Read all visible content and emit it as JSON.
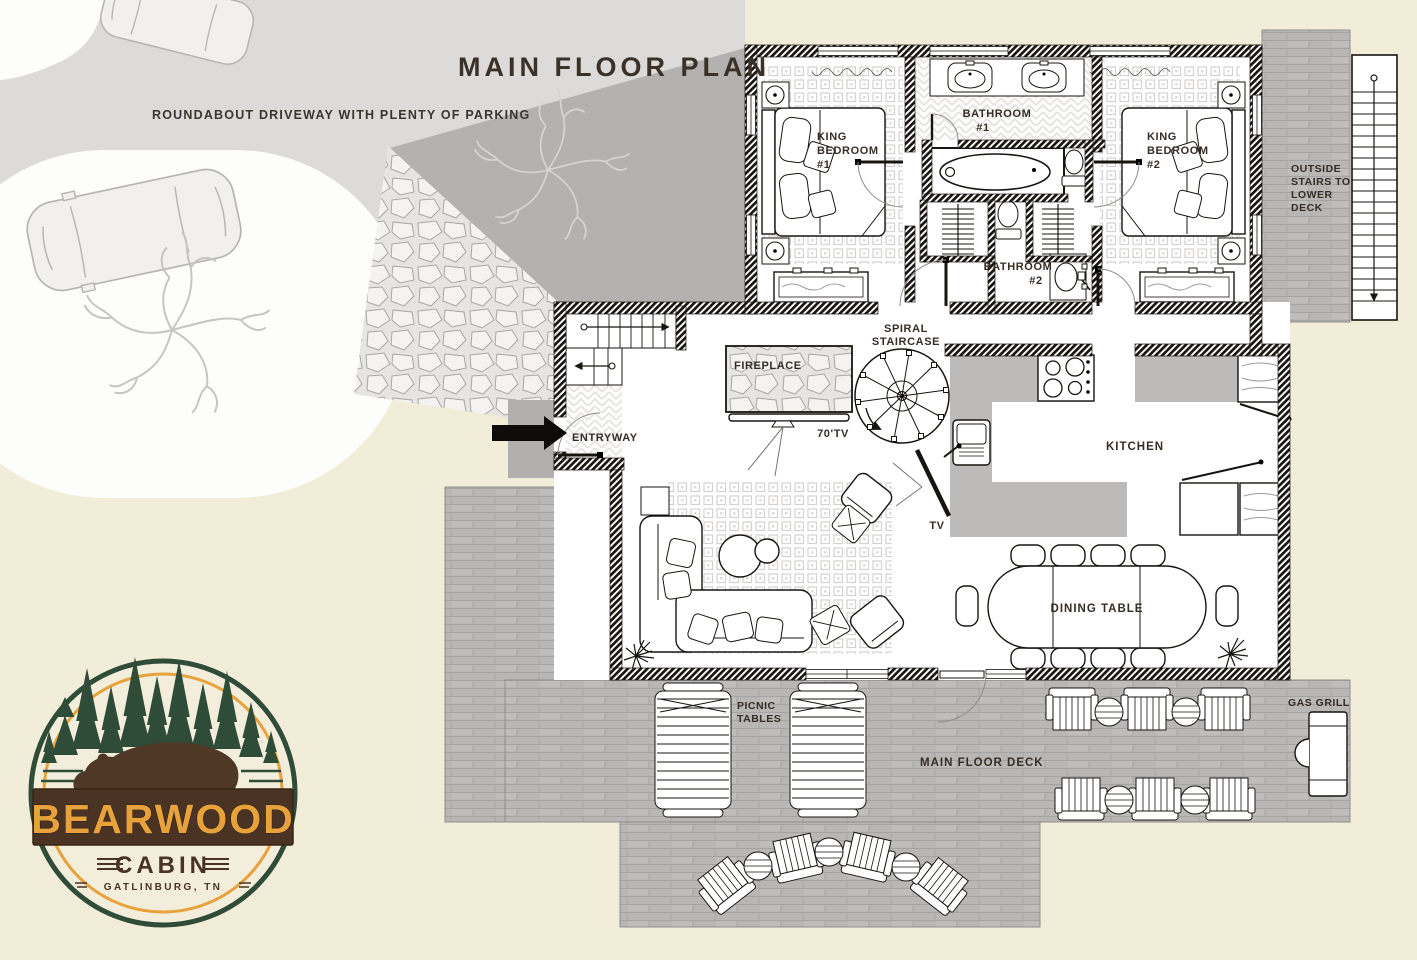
{
  "title": "MAIN FLOOR PLAN",
  "site": {
    "driveway_note": "ROUNDABOUT DRIVEWAY WITH PLENTY OF PARKING"
  },
  "rooms": {
    "bedroom1": [
      "KING",
      "BEDROOM",
      "#1"
    ],
    "bedroom2": [
      "KING",
      "BEDROOM",
      "#2"
    ],
    "bathroom1": [
      "BATHROOM",
      "#1"
    ],
    "bathroom2": [
      "BATHROOM",
      "#2"
    ],
    "kitchen": "KITCHEN",
    "entryway": "ENTRYWAY",
    "fireplace": "FIREPLACE",
    "spiral_staircase": [
      "SPIRAL",
      "STAIRCASE"
    ],
    "tv_main": "70'TV",
    "tv_side": "TV",
    "dining_table": "DINING TABLE"
  },
  "outdoor": {
    "outside_stairs": [
      "OUTSIDE",
      "STAIRS TO",
      "LOWER",
      "DECK"
    ],
    "picnic_tables": [
      "PICNIC",
      "TABLES"
    ],
    "main_floor_deck": "MAIN FLOOR DECK",
    "gas_grill": "GAS GRILL"
  },
  "logo": {
    "name": "BEARWOOD",
    "subtitle": "CABIN",
    "location": "GATLINBURG, TN"
  },
  "colors": {
    "cream": "#f2edd8",
    "driveway_gray": "#dcdbd9",
    "shadow_gray": "#b3b2b0",
    "deck_gray": "#b8b7b5",
    "wall_black": "#17150f",
    "text_brown": "#362d25",
    "logo_green": "#2f4c38",
    "logo_gold": "#e8a23c",
    "logo_brown": "#4a3323"
  }
}
